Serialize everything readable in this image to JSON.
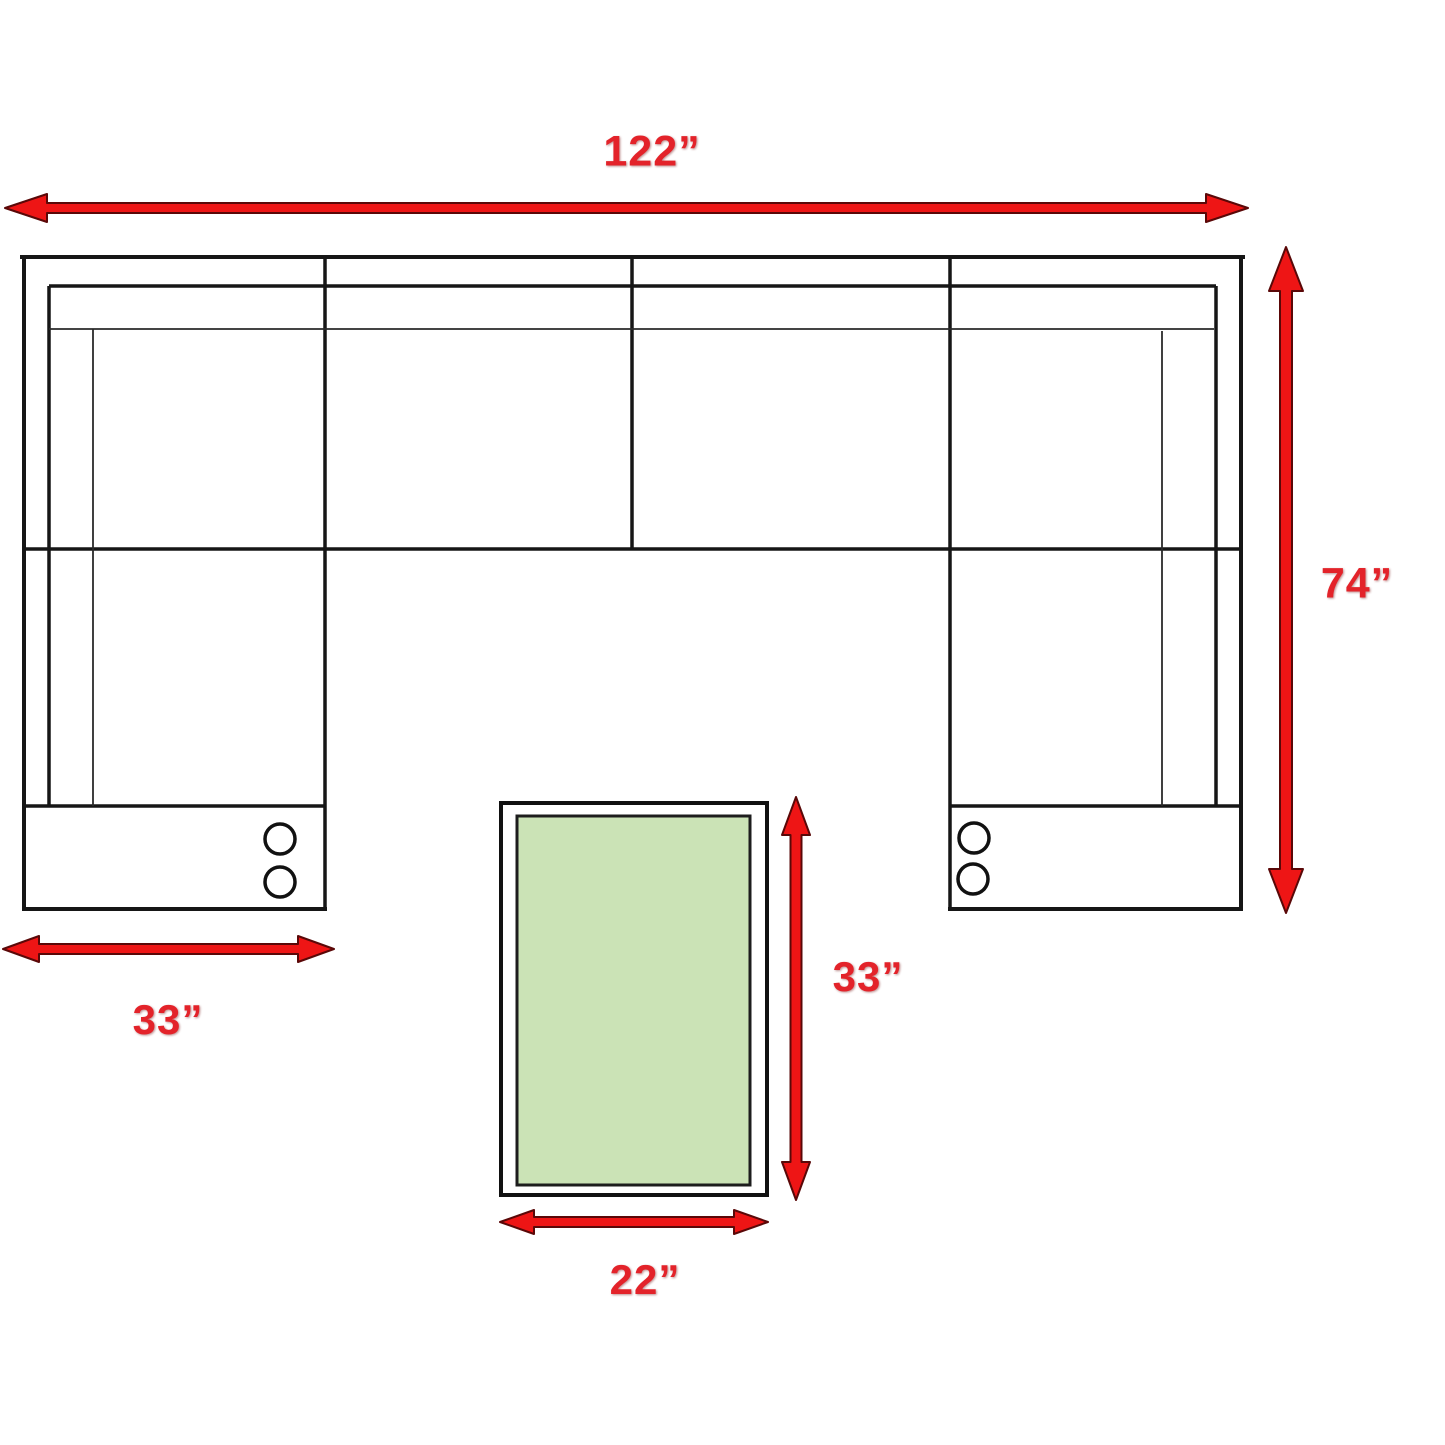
{
  "diagram": {
    "kind": "furniture-dimension-diagram",
    "subject": "U-shaped sectional sofa with ottoman, top-down plan view",
    "labels": {
      "sofa_width": "122”",
      "sofa_depth": "74”",
      "chaise_width": "33”",
      "ottoman_length": "33”",
      "ottoman_width": "22”"
    },
    "colors": {
      "background": "#ffffff",
      "line_black": "#161616",
      "arrow_red": "#ee1515",
      "arrow_outline": "#5a0808",
      "label_red": "#e3232a",
      "ottoman_green": "#cbe3b6"
    }
  }
}
